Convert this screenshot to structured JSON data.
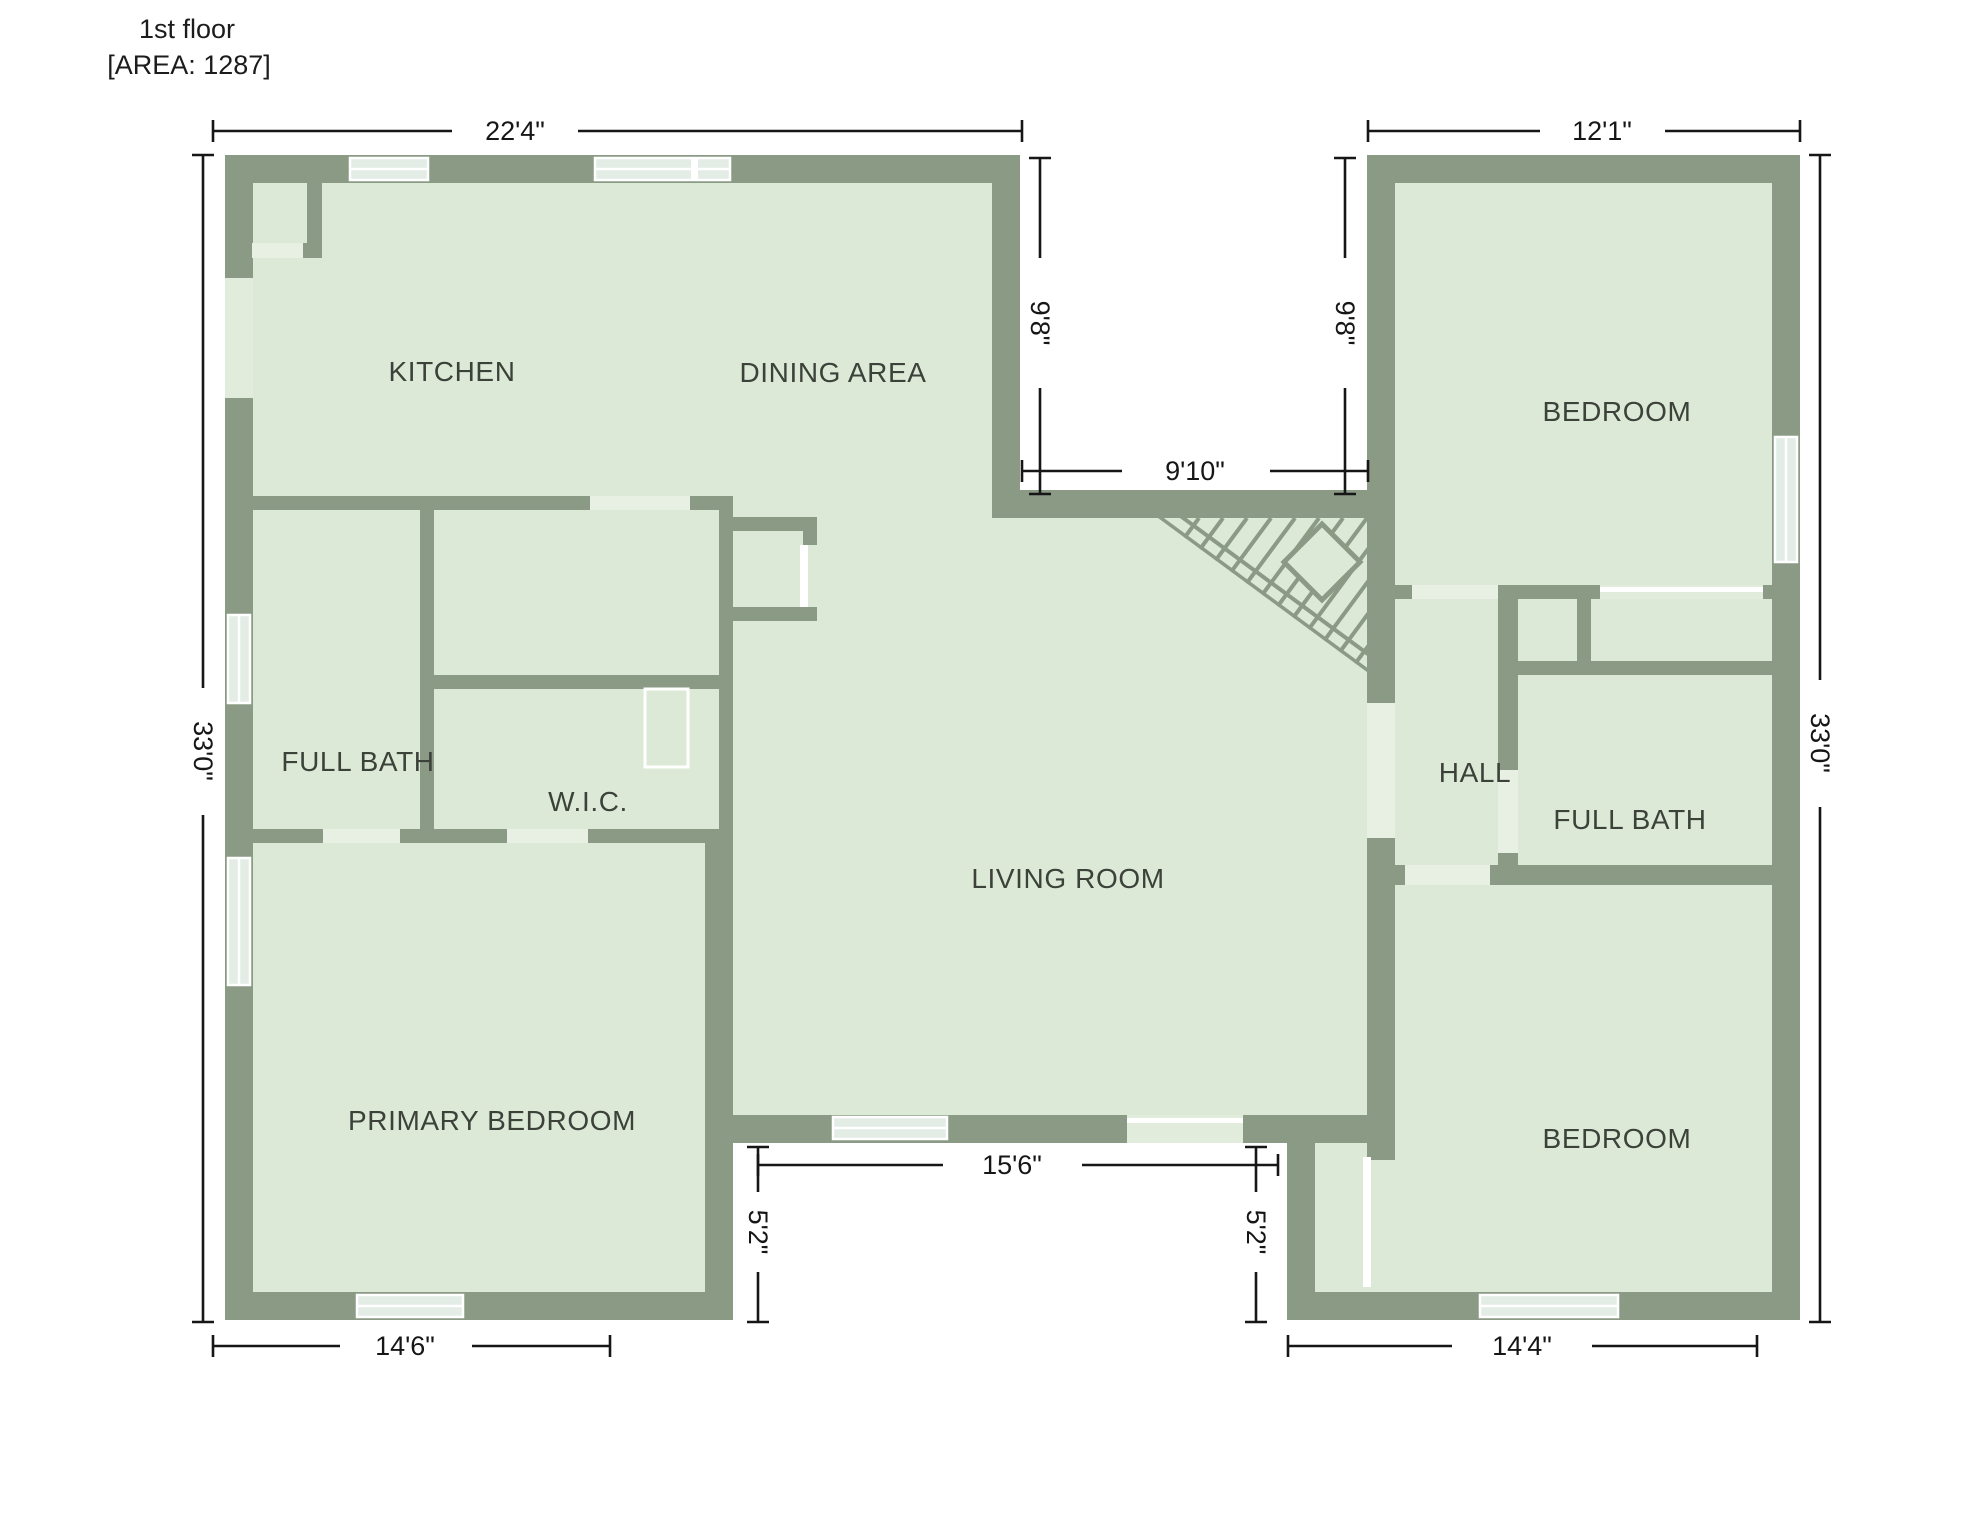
{
  "title": {
    "floor": "1st floor",
    "area": "[AREA: 1287]"
  },
  "rooms": {
    "kitchen": "KITCHEN",
    "dining": "DINING AREA",
    "bedroom_top_right": "BEDROOM",
    "full_bath_left": "FULL BATH",
    "wic": "W.I.C.",
    "hall": "HALL",
    "full_bath_right": "FULL BATH",
    "living": "LIVING ROOM",
    "primary_bedroom": "PRIMARY BEDROOM",
    "bedroom_bottom_right": "BEDROOM"
  },
  "dimensions": {
    "top_left_width": "22'4\"",
    "top_right_width": "12'1\"",
    "left_height": "33'0\"",
    "right_height": "33'0\"",
    "notch_left_height": "9'8\"",
    "notch_right_height": "9'8\"",
    "notch_width": "9'10\"",
    "bottom_middle_width": "15'6\"",
    "step_left_height": "5'2\"",
    "step_right_height": "5'2\"",
    "bottom_left_width": "14'6\"",
    "bottom_right_width": "14'4\""
  },
  "colors": {
    "wall": "#8b9a85",
    "floor": "#dbe9d6",
    "gap": "#e8f0e3",
    "glass": "#e3ece5",
    "opening": "#e2ecdd",
    "dim": "#161616",
    "label": "#3c423a"
  }
}
